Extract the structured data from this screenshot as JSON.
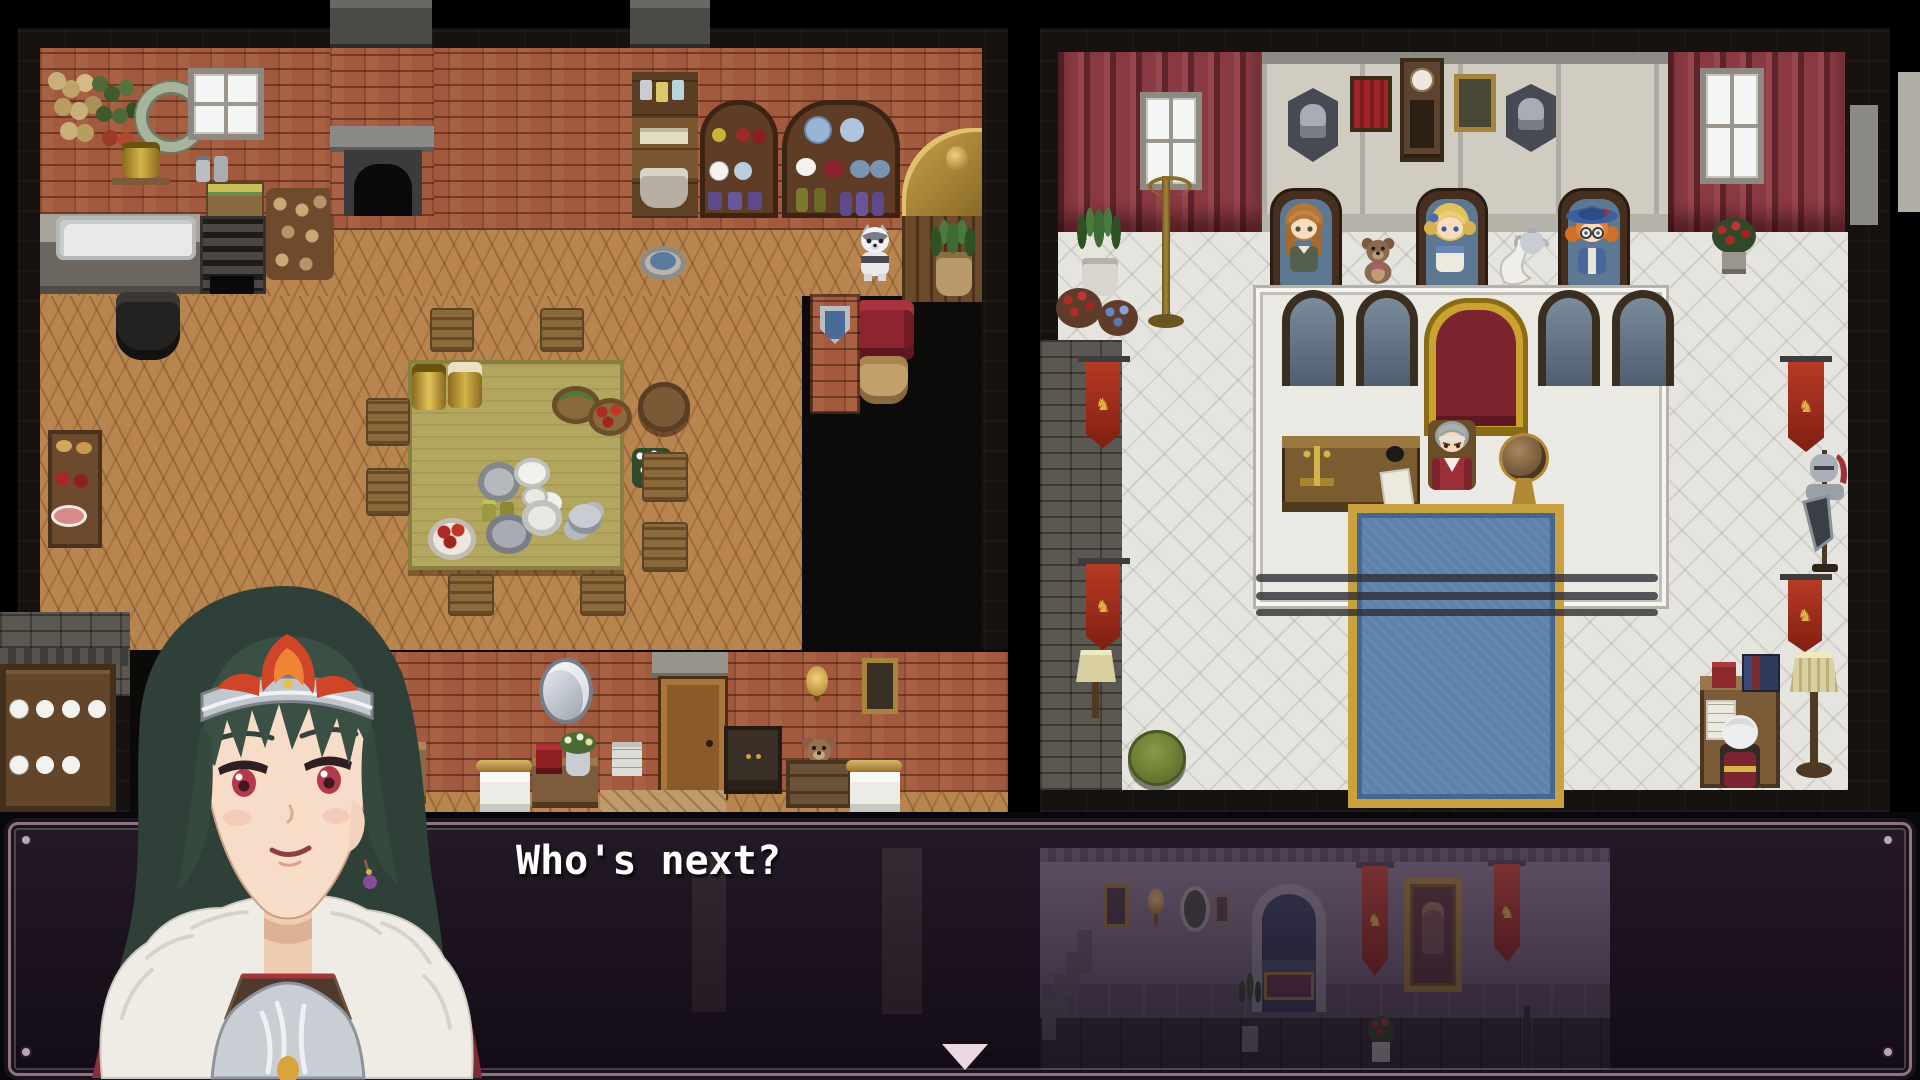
{
  "dialogue": {
    "text": "Who's next?",
    "speaker_portrait": "green-haired-noble-in-silver-armor-fur-cloak"
  },
  "icons": {
    "banner_emblem": "♞",
    "continue_indicator": "▼"
  },
  "palette": {
    "dialogue_frame": "#8d7480",
    "dialogue_fill": "rgba(40,26,44,0.55)",
    "carpet_blue": "#5d81aa",
    "carpet_gold": "#c9a23f",
    "brick_wall": "#a2593d",
    "stone_floor": "#e6e4df",
    "curtain_red": "#8a3a42",
    "banner_red": "#a53322",
    "throne_red": "#7c2430",
    "throne_gold": "#c9a22f",
    "portrait_hair": "#36493f",
    "portrait_eyes": "#b23a4c"
  },
  "scene": {
    "left_room": "inn-kitchen",
    "lower_left_room": "bedroom",
    "right_room": "courtroom-hall",
    "bottom_area": "castle-corridor",
    "npcs": [
      {
        "name": "seated-woman-orange-hair"
      },
      {
        "name": "seated-girl-blonde"
      },
      {
        "name": "seated-girl-blue-witch-hat"
      },
      {
        "name": "judge-grey-hair-at-bench"
      },
      {
        "name": "scholar-white-hair-at-desk"
      },
      {
        "name": "white-dog"
      }
    ]
  }
}
